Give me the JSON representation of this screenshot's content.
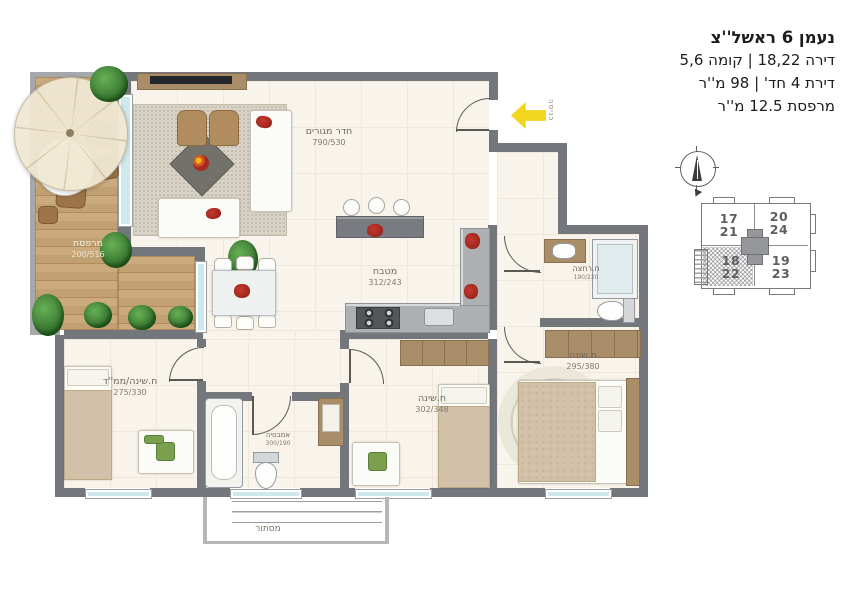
{
  "header": {
    "title": "נעמן 6 ראשל''צ",
    "line_apartment": "דירה 18,22 | קומה 5,6",
    "line_rooms": "דירת 4 חד' | 98 מ''ר",
    "line_balcony": "מרפסת 12.5 מ''ר"
  },
  "rooms": {
    "living": {
      "name": "חדר מגורים",
      "dims": "790/530"
    },
    "kitchen": {
      "name": "מטבח",
      "dims": "312/243"
    },
    "balcony": {
      "name": "מרפסת",
      "dims": "200/516"
    },
    "bathroom_top": {
      "name": "ח.רחצה",
      "dims": "190/220"
    },
    "bedroom_right": {
      "name": "ח.שינה",
      "dims": "295/380"
    },
    "bedroom_middle": {
      "name": "ח.שינה",
      "dims": "302/348"
    },
    "bedroom_safe": {
      "name": "ח.שינה/ממ''ד",
      "dims": "275/330"
    },
    "bath": {
      "name": "אמבטיה",
      "dims": "300/190"
    }
  },
  "annotations": {
    "entrance": "כניסה",
    "laundry": "מסתור"
  },
  "keyplan": {
    "units": [
      {
        "top": "17",
        "bottom": "21"
      },
      {
        "top": "20",
        "bottom": "24"
      },
      {
        "top": "18",
        "bottom": "22"
      },
      {
        "top": "19",
        "bottom": "23"
      }
    ],
    "highlighted_unit": "18/22"
  },
  "colors": {
    "wall": "#73767a",
    "floor": "#f8f4ec",
    "deck": "#c6a577",
    "window_glass": "#cde9ed",
    "entry_arrow": "#f2d51f",
    "accent_red": "#a9281f"
  }
}
